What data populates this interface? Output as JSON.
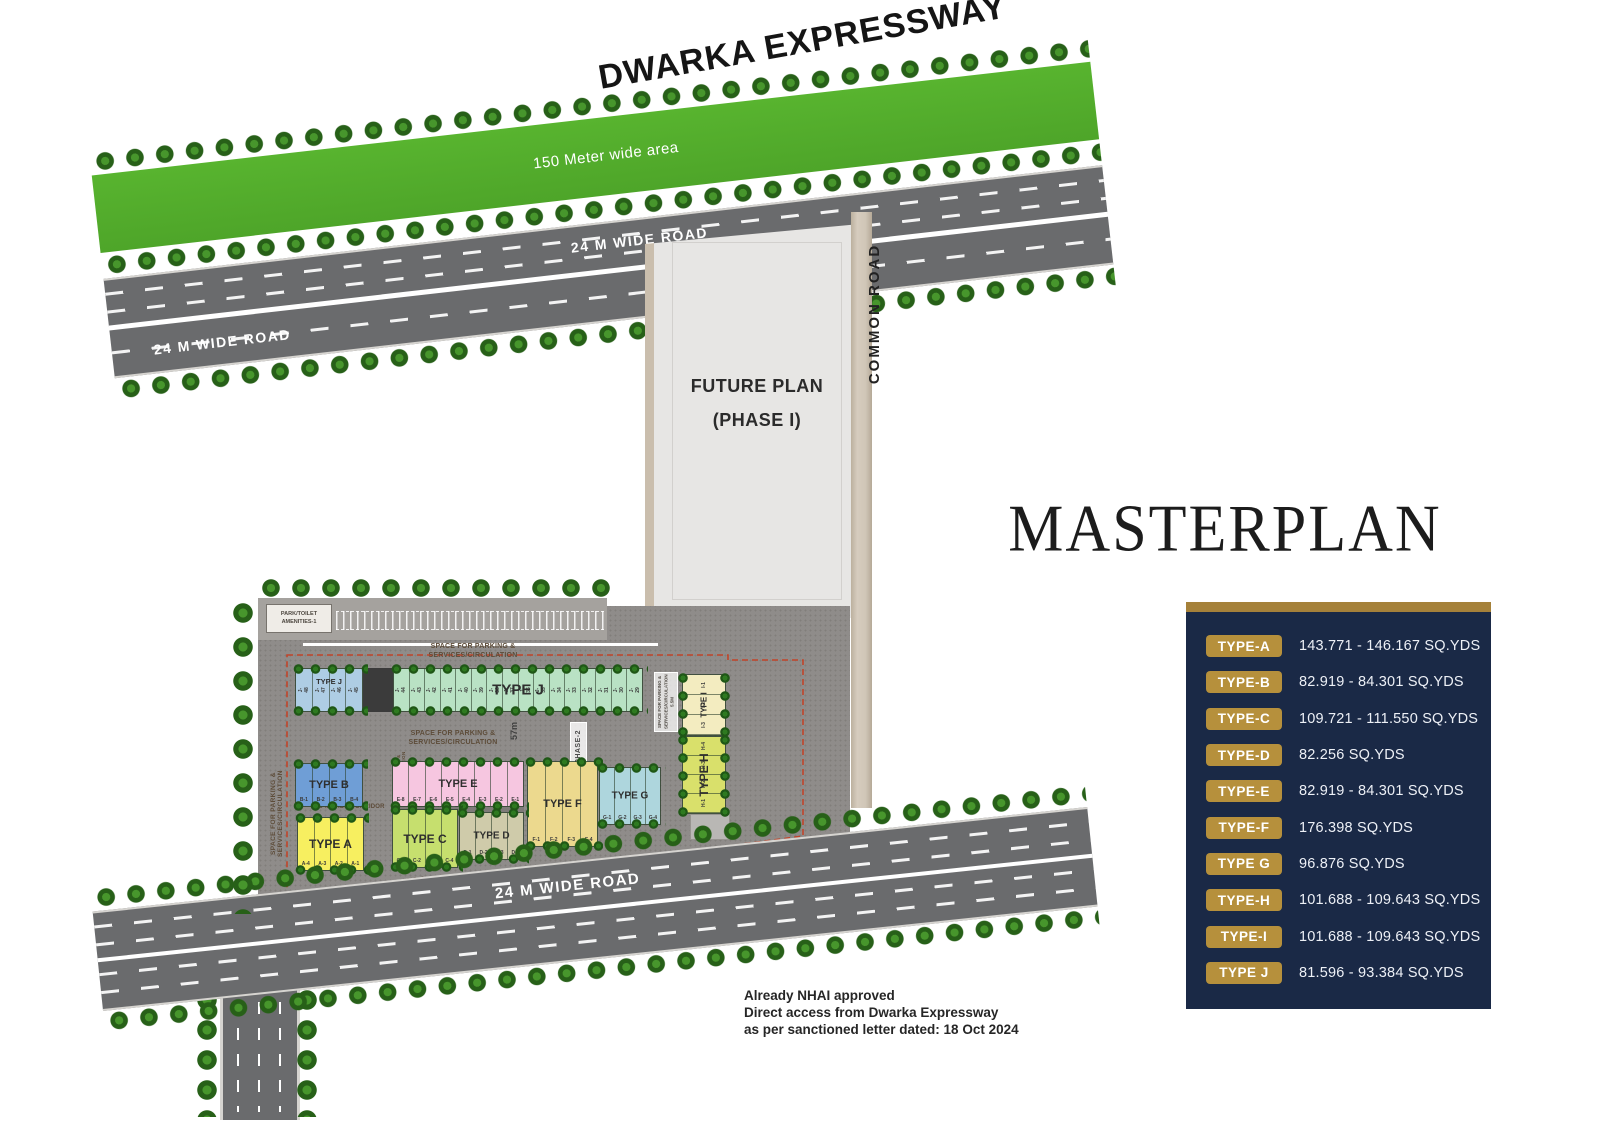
{
  "page": {
    "title": "MASTERPLAN"
  },
  "roads": {
    "expressway": "DWARKA EXPRESSWAY",
    "green_area": "150 Meter wide area",
    "top_right": "24 M WIDE ROAD",
    "top_left": "24 M WIDE ROAD",
    "bottom": "24 M WIDE ROAD",
    "common": "COMMON ROAD"
  },
  "future_plan": {
    "line1": "FUTURE PLAN",
    "line2": "(PHASE I)"
  },
  "site": {
    "amenities_line1": "PARK/TOILET",
    "amenities_line2": "AMENITIES-1",
    "parking_line1": "SPACE FOR PARKING &",
    "parking_line2": "SERVICES/CIRCULATION",
    "parking_combined": "SPACE FOR PARKING & SERVICES/CIRCULATION",
    "parking_box_vertical": "SPACE FOR PARKING & SERVICES/CIRCULATION 5.5M",
    "corridor": "6-M WIDE CORRIDOR",
    "internal_road": "INTERNAL ROAD 9'-0\"",
    "phase2": "PHASE-2",
    "dimension": "57m"
  },
  "plan": {
    "plot_groups": [
      {
        "id": "jblue",
        "title": "TYPE J",
        "color": "#aecde4",
        "orient": "h",
        "rot_ids": true,
        "ids": [
          "J-48",
          "J-47",
          "J-46",
          "J-45"
        ]
      },
      {
        "id": "jgreen",
        "title": "TYPE J",
        "color": "#b9e2c4",
        "orient": "h",
        "rot_ids": true,
        "ids": [
          "J-44",
          "J-43",
          "J-42",
          "J-41",
          "J-40",
          "J-39",
          "J-38",
          "J-37",
          "J-36",
          "J-35",
          "J-34",
          "J-33",
          "J-32",
          "J-31",
          "J-30",
          "J-29"
        ]
      },
      {
        "id": "b",
        "title": "TYPE B",
        "color": "#6f9ed6",
        "orient": "h",
        "rot_ids": false,
        "ids": [
          "B-1",
          "B-2",
          "B-3",
          "B-4"
        ]
      },
      {
        "id": "e",
        "title": "TYPE E",
        "color": "#f6c6e0",
        "orient": "h",
        "rot_ids": false,
        "ids": [
          "E-8",
          "E-7",
          "E-6",
          "E-5",
          "E-4",
          "E-3",
          "E-2",
          "E-1"
        ]
      },
      {
        "id": "f",
        "title": "TYPE F",
        "color": "#ecd98e",
        "orient": "h",
        "rot_ids": false,
        "ids": [
          "F-1",
          "F-2",
          "F-3",
          "F-4"
        ]
      },
      {
        "id": "g",
        "title": "TYPE G",
        "color": "#aed6dd",
        "orient": "h",
        "rot_ids": false,
        "ids": [
          "G-1",
          "G-2",
          "G-3",
          "G-4"
        ]
      },
      {
        "id": "a",
        "title": "TYPE A",
        "color": "#f7ef60",
        "orient": "h",
        "rot_ids": false,
        "ids": [
          "A-4",
          "A-3",
          "A-2",
          "A-1"
        ]
      },
      {
        "id": "c",
        "title": "TYPE C",
        "color": "#c6df6e",
        "orient": "h",
        "rot_ids": false,
        "ids": [
          "C-1",
          "C-2",
          "C-3",
          "C-4"
        ]
      },
      {
        "id": "d",
        "title": "TYPE D",
        "color": "#cfcbaa",
        "orient": "h",
        "rot_ids": false,
        "ids": [
          "D-1",
          "D-2",
          "D-3",
          "D-4"
        ]
      },
      {
        "id": "i",
        "title": "TYPE I",
        "color": "#f3ecc0",
        "orient": "v",
        "rot_ids": true,
        "ids": [
          "I-1",
          "I-2",
          "I-3"
        ]
      },
      {
        "id": "h",
        "title": "TYPE H",
        "color": "#d9e06b",
        "orient": "v",
        "rot_ids": true,
        "ids": [
          "H-4",
          "H-3",
          "H-2",
          "H-1"
        ]
      }
    ]
  },
  "legend": {
    "panel_navy": "#1a2946",
    "accent_gold": "#b6903c",
    "rows": [
      {
        "type": "TYPE-A",
        "value": "143.771 - 146.167 SQ.YDS"
      },
      {
        "type": "TYPE-B",
        "value": "82.919 - 84.301 SQ.YDS"
      },
      {
        "type": "TYPE-C",
        "value": "109.721 - 111.550 SQ.YDS"
      },
      {
        "type": "TYPE-D",
        "value": "82.256 SQ.YDS"
      },
      {
        "type": "TYPE-E",
        "value": "82.919 - 84.301 SQ.YDS"
      },
      {
        "type": "TYPE-F",
        "value": "176.398 SQ.YDS"
      },
      {
        "type": "TYPE G",
        "value": "96.876 SQ.YDS"
      },
      {
        "type": "TYPE-H",
        "value": "101.688 - 109.643 SQ.YDS"
      },
      {
        "type": "TYPE-I",
        "value": "101.688 - 109.643 SQ.YDS"
      },
      {
        "type": "TYPE J",
        "value": "81.596 - 93.384 SQ.YDS"
      }
    ]
  },
  "annotation": {
    "line1": "Already NHAI approved",
    "line2": "Direct access from Dwarka Expressway",
    "line3": "as per sanctioned letter dated: 18 Oct 2024"
  }
}
